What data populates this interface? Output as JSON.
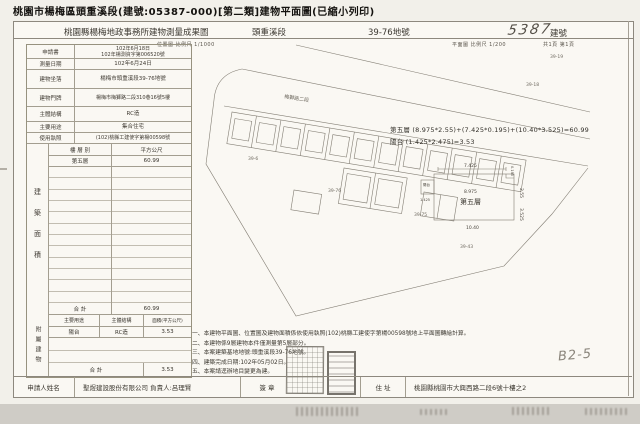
{
  "page_title": "桃園市楊梅區頭重溪段(建號:05387-000)[第二類]建物平面圖(已縮小列印)",
  "header": {
    "office": "桃園縣楊梅地政事務所建物測量成果圖",
    "section": "頭重溪段",
    "parcel_no": "39-76地號",
    "building_no_handwritten": "5387",
    "building_no_label": "建號",
    "scale_location": "位置圖 比例尺 1/1000",
    "scale_plan": "平面圖 比例尺 1/200",
    "page_count": "共1頁 第1頁"
  },
  "info_rows": [
    {
      "label": "申請書",
      "value": "102年6月18日",
      "value2": "102年楊測資字第006520號"
    },
    {
      "label": "測量日期",
      "value": "102年6月24日"
    },
    {
      "label": "建物坐落",
      "value": "楊梅市頭重溪段39-76地號"
    },
    {
      "label": "建物門牌",
      "value": "楊梅市梅獅路二段310巷16號5樓"
    },
    {
      "label": "主體結構",
      "value": "RC造"
    },
    {
      "label": "主要用途",
      "value": "集合住宅"
    },
    {
      "label": "使用執照",
      "value": "(102)桃縣工建使字第楊00598號"
    }
  ],
  "floor_area": {
    "vertical_label": "建築面積",
    "col_floor": "樓 層 別",
    "col_area": "平方公尺",
    "rows": [
      {
        "floor": "第五層",
        "area": "60.99"
      }
    ],
    "total_label": "合 計",
    "total": "60.99"
  },
  "attached": {
    "vertical_label": "附屬建物",
    "col_use": "主要用途",
    "col_struct": "主體結構",
    "col_area": "面積(平方公尺)",
    "rows": [
      {
        "use": "陽台",
        "struct": "RC造",
        "area": "3.53"
      }
    ],
    "total_label": "合 計",
    "total": "3.53"
  },
  "formulas": {
    "line1": "第五層 (8.975*2.55)+(7.425*0.195)+(10.40*3.525)=60.99",
    "line2": "陽台 (1.425*2.475)=3.53"
  },
  "plan": {
    "room_label": "第五層",
    "room_width": "8.975",
    "balcony_label": "陽台",
    "balcony_width": "1.425",
    "dim_top": "7.425",
    "dim_bottom": "10.40",
    "dim_right_upper": "2.55",
    "dim_right_lower": "3.525",
    "dim_step": "0.195"
  },
  "notes": [
    "一、本建物平面圖、位置圖及建物面積係依使用執照(102)桃縣工建使字第楊00598號地上平面圖轉繪計算。",
    "二、本建物係9層建物本件僅測量第5層部分。",
    "三、本案建築基地地號:頭重溪段39-76地號。",
    "四、建築完成日期:102年05月02日。",
    "五、本案請逕辦地目變更為建。"
  ],
  "map": {
    "road_label": "梅獅路二段",
    "labels": [
      {
        "t": "39-19",
        "x": 352,
        "y": 16
      },
      {
        "t": "39-18",
        "x": 328,
        "y": 44
      },
      {
        "t": "39-6",
        "x": 50,
        "y": 118
      },
      {
        "t": "39-76",
        "x": 130,
        "y": 150
      },
      {
        "t": "39-75",
        "x": 216,
        "y": 174
      },
      {
        "t": "39-43",
        "x": 262,
        "y": 206
      }
    ]
  },
  "applicant": {
    "label": "申請人姓名",
    "name": "聖煜建設股份有限公司 負責人:呂理賢",
    "sign_label": "簽 章",
    "addr_label": "住 址",
    "address": "桃園縣桃園市大興西路二段6號十樓之2"
  },
  "annotations": {
    "handwritten_note": "B2-5"
  }
}
